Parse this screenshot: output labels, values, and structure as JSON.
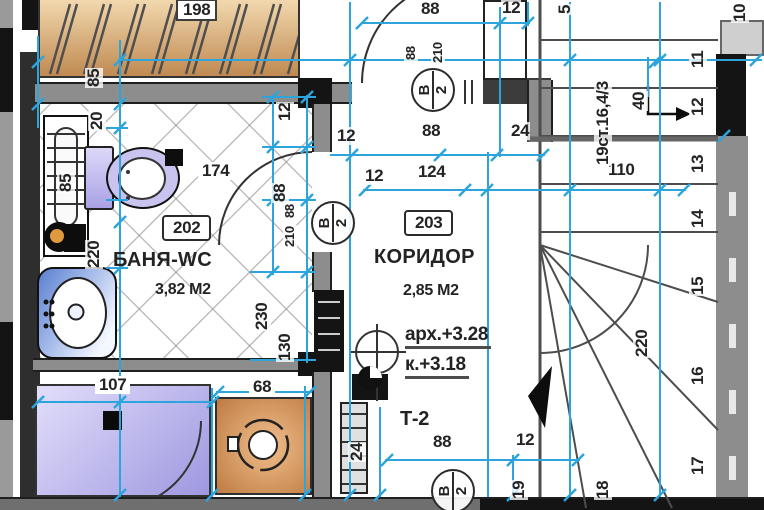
{
  "colors": {
    "dimension_line": "#2DA4DC",
    "wall_gray": "#8d8d8d",
    "wardrobe_fill": "#D8A468",
    "washing_machine_fill": "#C9854F",
    "shower_fill": "#BDB7EC",
    "fixture_lavender": "#C9C3F0",
    "sink_blue": "#5B7FD0"
  },
  "rooms": {
    "bathroom": {
      "tag": "202",
      "name": "БАНЯ-WC",
      "area": "3,82 М2"
    },
    "corridor": {
      "tag": "203",
      "name": "КОРИДОР",
      "area": "2,85 М2",
      "level_arch": "арх.+3.28",
      "level_finish": "к.+3.18",
      "radiator_tag": "Т-2"
    }
  },
  "dimensions": [
    {
      "n": "dim-198",
      "t": "198",
      "x": 176,
      "y": -1,
      "c": "chip"
    },
    {
      "n": "dim-85-top",
      "t": "85",
      "x": 85,
      "y": 88,
      "c": "v"
    },
    {
      "n": "dim-20",
      "t": "20",
      "x": 88,
      "y": 131,
      "c": "v"
    },
    {
      "n": "dim-85-radiator",
      "t": "85",
      "x": 57,
      "y": 193,
      "c": "v"
    },
    {
      "n": "dim-220-left",
      "t": "220",
      "x": 85,
      "y": 269,
      "c": "v"
    },
    {
      "n": "dim-174",
      "t": "174",
      "x": 198,
      "y": 162,
      "c": "chip2"
    },
    {
      "n": "dim-12-wall-v",
      "t": "12",
      "x": 276,
      "y": 122,
      "c": "v"
    },
    {
      "n": "dim-88-wall-v",
      "t": "88",
      "x": 271,
      "y": 203,
      "c": "v"
    },
    {
      "n": "dim-88-door-bath",
      "t": "88",
      "x": 283,
      "y": 219,
      "c": "v sm"
    },
    {
      "n": "dim-210-door-bath",
      "t": "210",
      "x": 283,
      "y": 248,
      "c": "v sm"
    },
    {
      "n": "dim-230",
      "t": "230",
      "x": 253,
      "y": 331,
      "c": "v"
    },
    {
      "n": "dim-130",
      "t": "130",
      "x": 276,
      "y": 362,
      "c": "v"
    },
    {
      "n": "dim-12-a",
      "t": "12",
      "x": 336,
      "y": 127
    },
    {
      "n": "dim-12-b",
      "t": "12",
      "x": 364,
      "y": 167
    },
    {
      "n": "dim-88-top",
      "t": "88",
      "x": 420,
      "y": 0
    },
    {
      "n": "dim-88-door-top",
      "t": "88",
      "x": 404,
      "y": 61,
      "c": "v sm"
    },
    {
      "n": "dim-210-door-top",
      "t": "210",
      "x": 431,
      "y": 64,
      "c": "v sm"
    },
    {
      "n": "dim-12-top",
      "t": "12",
      "x": 501,
      "y": -1
    },
    {
      "n": "dim-5",
      "t": "5",
      "x": 556,
      "y": 15,
      "c": "v"
    },
    {
      "n": "dim-88-mid",
      "t": "88",
      "x": 421,
      "y": 122
    },
    {
      "n": "dim-24-mid",
      "t": "24",
      "x": 510,
      "y": 122
    },
    {
      "n": "dim-124",
      "t": "124",
      "x": 417,
      "y": 163
    },
    {
      "n": "dim-110",
      "t": "110",
      "x": 607,
      "y": 161
    },
    {
      "n": "stair-spec",
      "t": "19ст.16,4/3",
      "x": 594,
      "y": 166,
      "c": "v"
    },
    {
      "n": "dim-40",
      "t": "40",
      "x": 630,
      "y": 111,
      "c": "v"
    },
    {
      "n": "dim-220-stairs",
      "t": "220",
      "x": 633,
      "y": 358,
      "c": "v"
    },
    {
      "n": "dim-107",
      "t": "107",
      "x": 95,
      "y": 376,
      "c": "chip2"
    },
    {
      "n": "dim-68",
      "t": "68",
      "x": 249,
      "y": 378,
      "c": "chip2"
    },
    {
      "n": "dim-24-radiator",
      "t": "24",
      "x": 348,
      "y": 462,
      "c": "v"
    },
    {
      "n": "dim-88-bottom",
      "t": "88",
      "x": 432,
      "y": 433
    },
    {
      "n": "dim-12-bottom",
      "t": "12",
      "x": 515,
      "y": 431
    },
    {
      "n": "dim-19",
      "t": "19",
      "x": 510,
      "y": 500,
      "c": "v"
    }
  ],
  "stair_numbers": [
    {
      "n": "stair-num-10",
      "t": "10",
      "x": 731,
      "y": 23
    },
    {
      "n": "stair-num-11",
      "t": "11",
      "x": 689,
      "y": 69
    },
    {
      "n": "stair-num-12",
      "t": "12",
      "x": 689,
      "y": 117
    },
    {
      "n": "stair-num-13",
      "t": "13",
      "x": 689,
      "y": 174
    },
    {
      "n": "stair-num-14",
      "t": "14",
      "x": 689,
      "y": 229
    },
    {
      "n": "stair-num-15",
      "t": "15",
      "x": 689,
      "y": 296
    },
    {
      "n": "stair-num-16",
      "t": "16",
      "x": 689,
      "y": 386
    },
    {
      "n": "stair-num-17",
      "t": "17",
      "x": 689,
      "y": 476
    },
    {
      "n": "stair-num-18",
      "t": "18",
      "x": 594,
      "y": 500
    }
  ],
  "door_tags": [
    {
      "n": "door-tag-corridor-top",
      "top": "В",
      "bottom": "2",
      "x": 411,
      "y": 68
    },
    {
      "n": "door-tag-bathroom",
      "top": "В",
      "bottom": "2",
      "x": 311,
      "y": 201
    },
    {
      "n": "door-tag-bottom",
      "top": "В",
      "bottom": "2",
      "x": 431,
      "y": 469
    }
  ]
}
